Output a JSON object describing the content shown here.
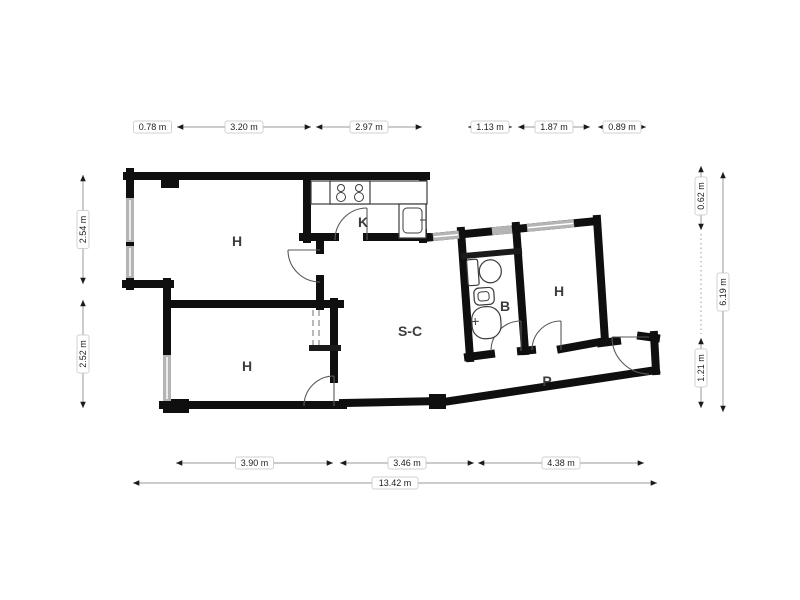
{
  "plan": {
    "rooms": [
      {
        "id": "bedroom-top-left",
        "label": "H"
      },
      {
        "id": "kitchen",
        "label": "K"
      },
      {
        "id": "living-dining",
        "label": "S-C"
      },
      {
        "id": "bathroom",
        "label": "B"
      },
      {
        "id": "bedroom-right",
        "label": "H"
      },
      {
        "id": "bedroom-bottom-left",
        "label": "H"
      },
      {
        "id": "hallway",
        "label": "P"
      }
    ],
    "icons": [
      "stove-icon",
      "kitchen-sink-icon",
      "toilet-icon",
      "bidet-icon",
      "washbasin-icon",
      "door-swing-icon",
      "window-icon"
    ],
    "colors": {
      "wall": "#0f0f0f",
      "window": "#b4b4b4",
      "dimension_line": "#999999",
      "dimension_arrow": "#1a1a1a",
      "room_label": "#3d3d3d",
      "fixture_outline": "#3c3c3c",
      "background": "#ffffff"
    }
  },
  "dimensions": {
    "top": [
      "0.78 m",
      "3.20 m",
      "2.97 m",
      "1.13 m",
      "1.87 m",
      "0.89 m"
    ],
    "left": [
      "2.54 m",
      "2.52 m"
    ],
    "right": [
      "0.62 m",
      "1.21 m",
      "6.19 m"
    ],
    "bottom": [
      "3.90 m",
      "3.46 m",
      "4.38 m"
    ],
    "bottom_total": "13.42 m"
  }
}
